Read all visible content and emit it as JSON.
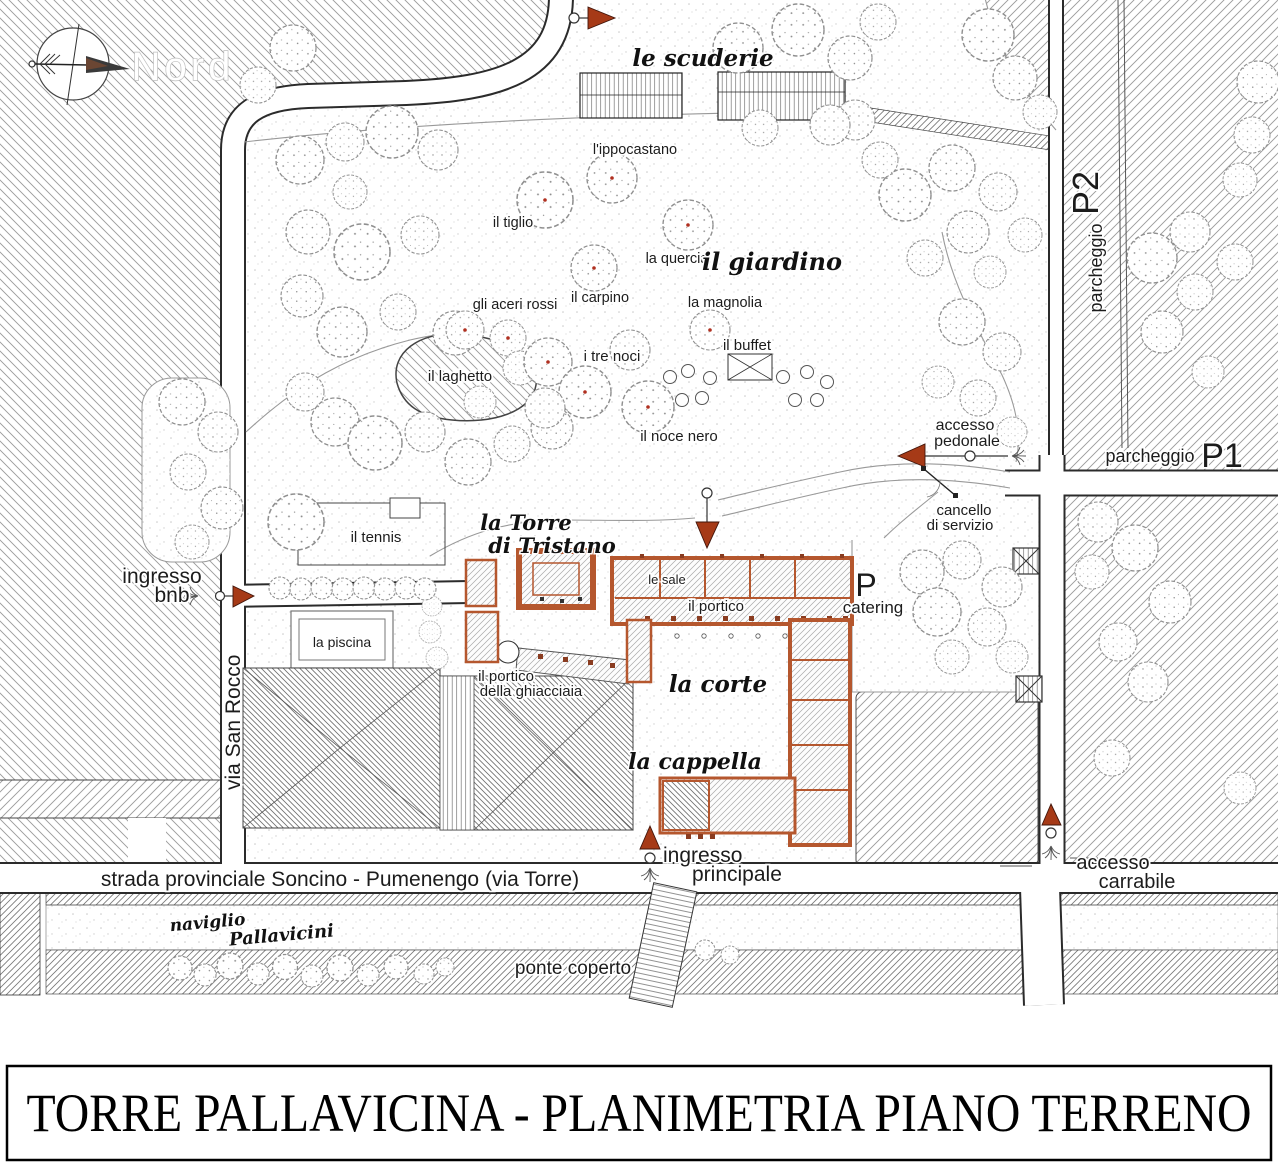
{
  "title_block": {
    "title": "TORRE PALLAVICINA - PLANIMETRIA PIANO TERRENO"
  },
  "compass": {
    "north": "Nord"
  },
  "parking": {
    "p1_word": "parcheggio",
    "p1_code": "P1",
    "p2_word": "parcheggio",
    "p2_code": "P2"
  },
  "roads": {
    "via_san_rocco": "via San Rocco",
    "strada_provinciale": "strada provinciale Soncino - Pumenengo  (via Torre)",
    "naviglio_word": "naviglio",
    "naviglio_name": "Pallavicini",
    "ponte_coperto": "ponte coperto"
  },
  "garden": {
    "name": "il giardino",
    "ippocastano": "l'ippocastano",
    "tiglio": "il tiglio",
    "quercia": "la quercia",
    "carpino": "il carpino",
    "aceri_rossi": "gli aceri rossi",
    "magnolia": "la magnolia",
    "laghetto": "il laghetto",
    "tre_noci": "i tre noci",
    "noce_nero": "il noce nero",
    "buffet": "il buffet"
  },
  "buildings": {
    "scuderie": "le scuderie",
    "torre_l1": "la Torre",
    "torre_l2": "di Tristano",
    "sale": "le sale",
    "portico": "il portico",
    "corte": "la corte",
    "cappella": "la cappella",
    "ghiacciaia_l1": "il portico",
    "ghiacciaia_l2": "della ghiacciaia",
    "tennis": "il tennis",
    "piscina": "la piscina",
    "catering_p": "P",
    "catering": "catering"
  },
  "access": {
    "pedonale_l1": "accesso",
    "pedonale_l2": "pedonale",
    "cancello_l1": "cancello",
    "cancello_l2": "di servizio",
    "bnb_l1": "ingresso",
    "bnb_l2": "bnb",
    "principale_l1": "ingresso",
    "principale_l2": "principale",
    "carrabile_l1": "accesso",
    "carrabile_l2": "carrabile"
  },
  "colors": {
    "entry_arrow": "#a63a17",
    "wall": "#b5572e"
  }
}
